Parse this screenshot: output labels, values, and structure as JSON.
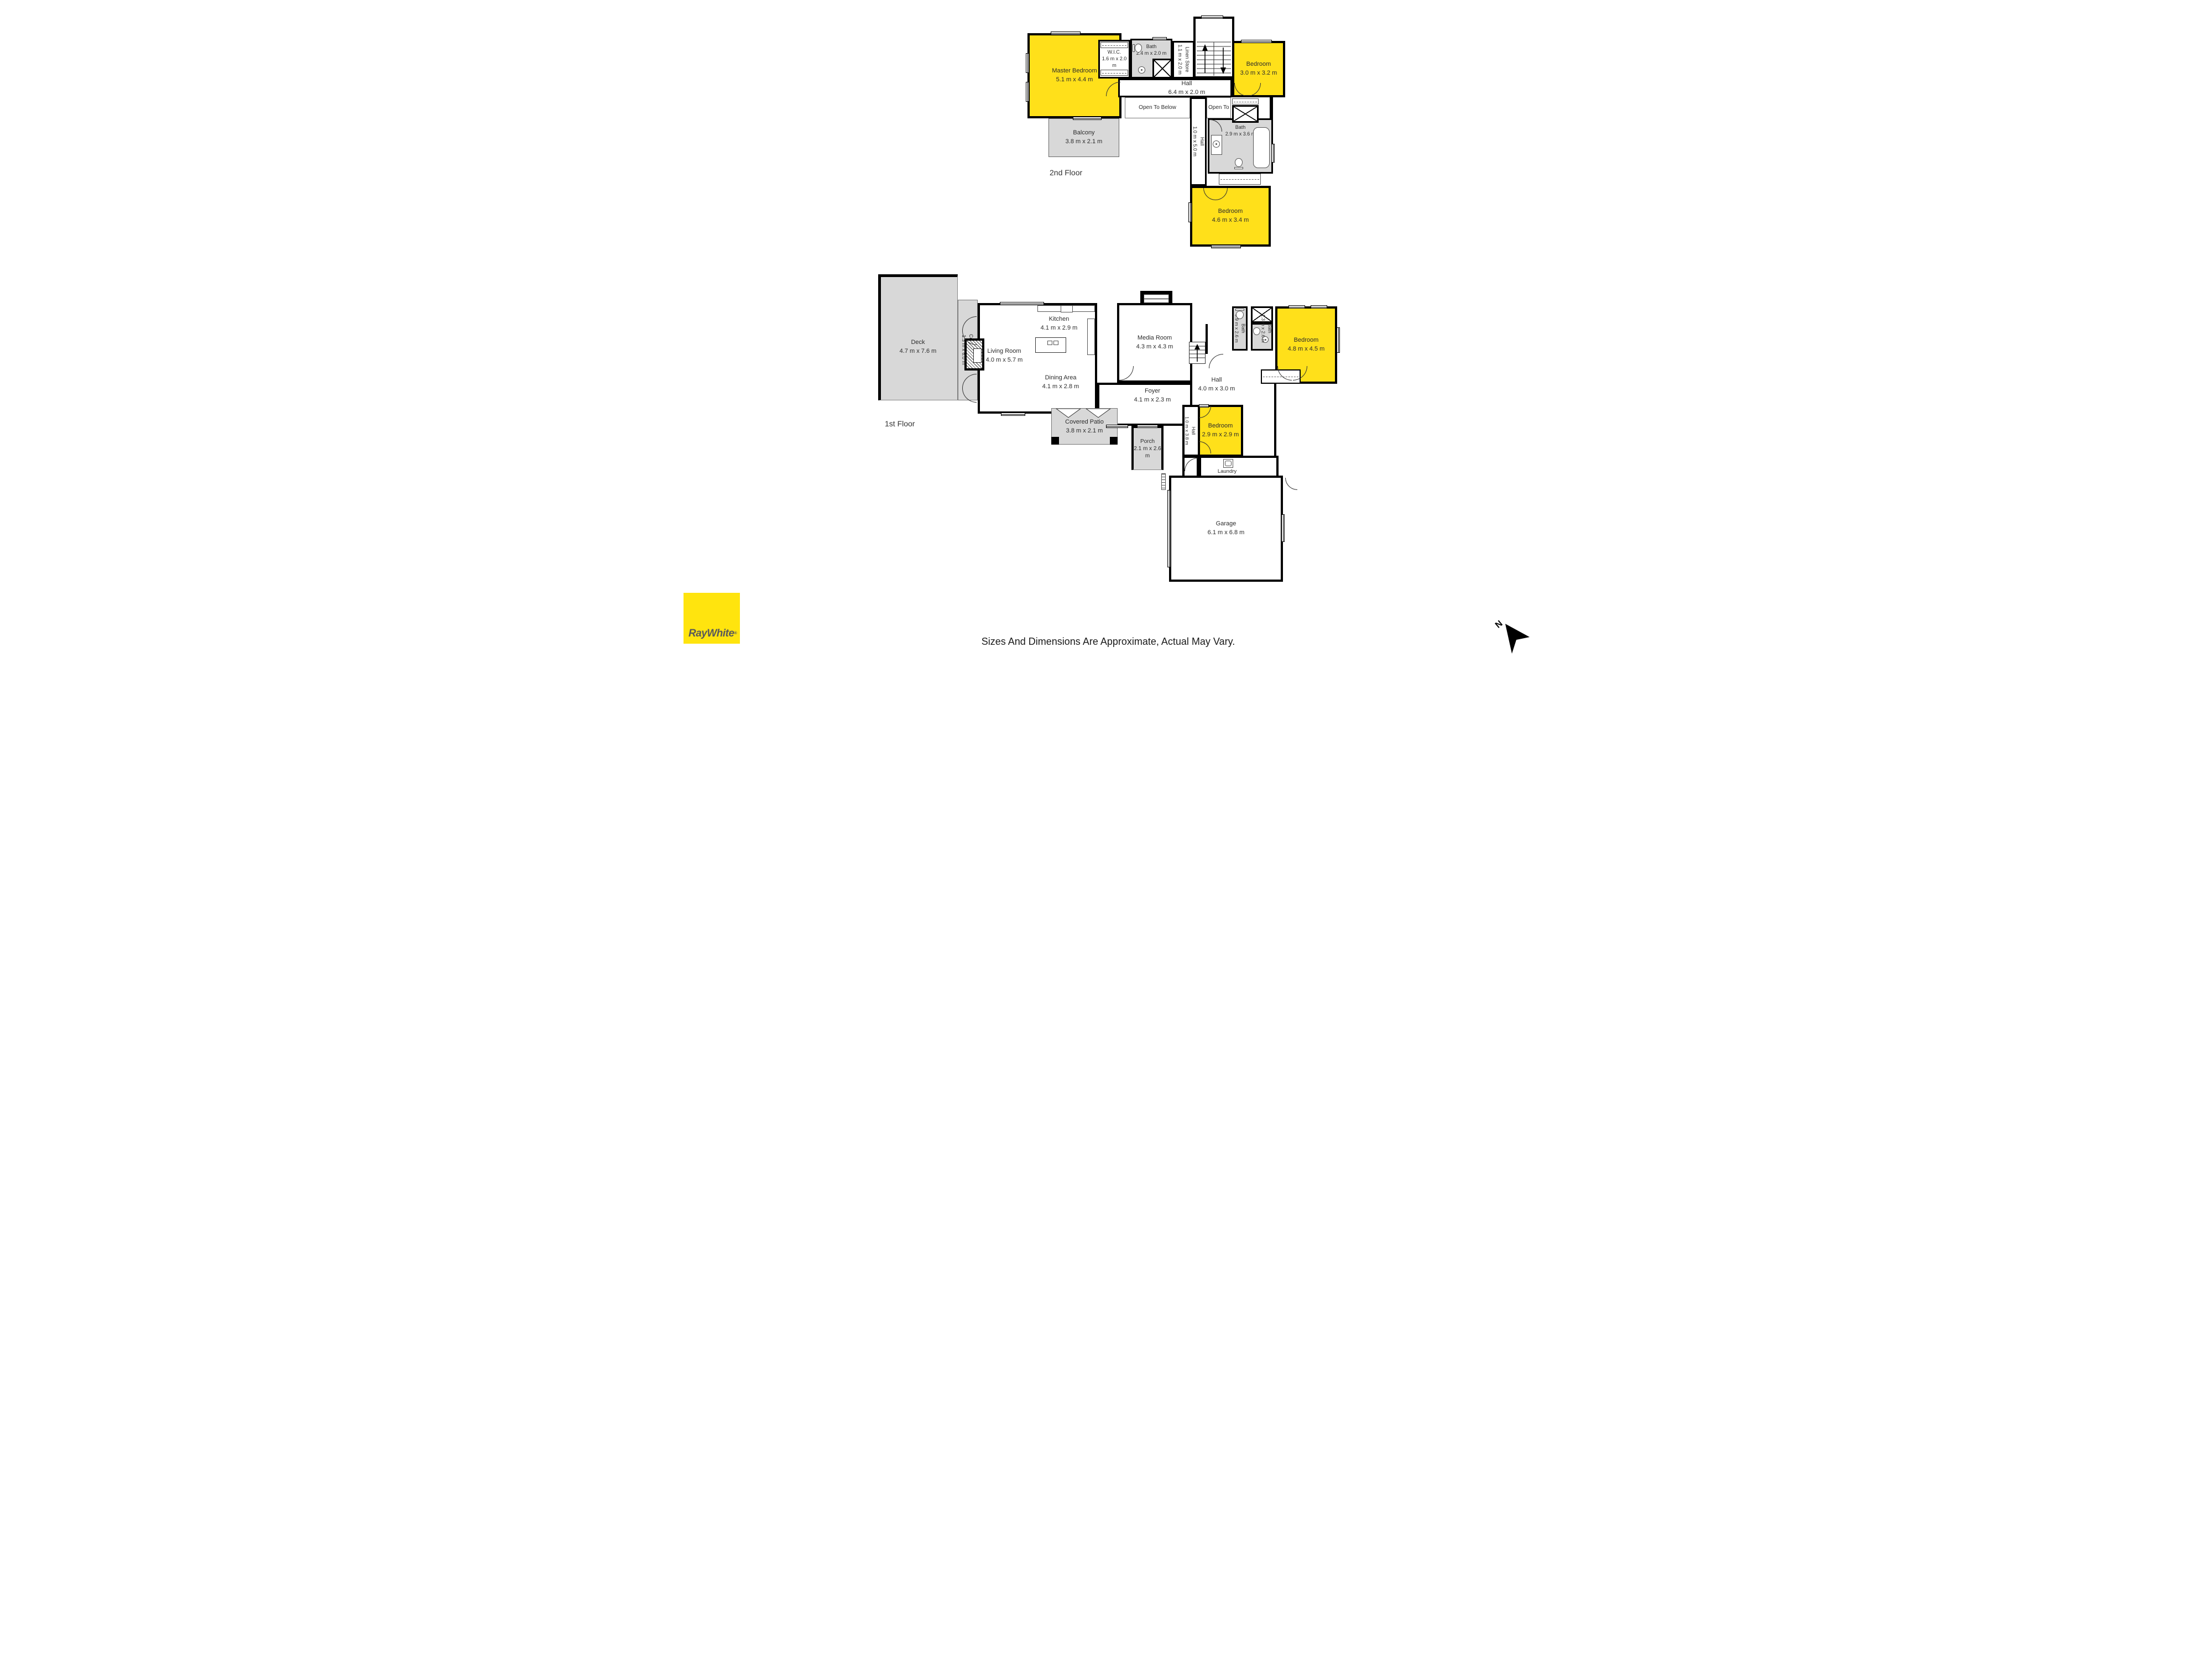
{
  "second_floor": {
    "floor_label": "2nd Floor",
    "master_bedroom": {
      "name": "Master Bedroom",
      "dims": "5.1 m x 4.4 m"
    },
    "wic": {
      "name": "W.I.C.",
      "dims": "1.6 m x 2.0 m"
    },
    "bath_a": {
      "name": "Bath",
      "dims": "2.4 m x 2.0 m"
    },
    "linen_store": {
      "name": "Linen Store",
      "dims": "1.1 m x 2.0 m"
    },
    "hall": {
      "name": "Hall",
      "dims": "6.4 m x 2.0 m"
    },
    "hall_vertical": {
      "name": "Hall",
      "dims": "1.0 m x 5.0 m"
    },
    "open_to_below_left": "Open To Below",
    "open_to_below_right": "Open To Below",
    "bedroom_ne": {
      "name": "Bedroom",
      "dims": "3.0 m x 3.2 m"
    },
    "bath_b": {
      "name": "Bath",
      "dims": "2.9 m x 3.6 m"
    },
    "bedroom_s": {
      "name": "Bedroom",
      "dims": "4.6 m x 3.4 m"
    },
    "balcony": {
      "name": "Balcony",
      "dims": "3.8 m x 2.1 m"
    }
  },
  "first_floor": {
    "floor_label": "1st Floor",
    "deck": {
      "name": "Deck",
      "dims": "4.7 m x 7.6 m"
    },
    "covered_deck": {
      "name": "Covered Deck",
      "dims": "1.3 m x 6.0 m"
    },
    "living_room": {
      "name": "Living Room",
      "dims": "4.0 m x 5.7 m"
    },
    "kitchen": {
      "name": "Kitchen",
      "dims": "4.1 m x 2.9 m"
    },
    "dining_area": {
      "name": "Dining Area",
      "dims": "4.1 m x 2.8 m"
    },
    "media_room": {
      "name": "Media Room",
      "dims": "4.3 m x 4.3 m"
    },
    "foyer": {
      "name": "Foyer",
      "dims": "4.1 m x 2.3 m"
    },
    "hall": {
      "name": "Hall",
      "dims": "4.0 m x 3.0 m"
    },
    "hall_vertical": {
      "name": "Hall",
      "dims": "1.0 m x 3.8 m"
    },
    "bath_small": {
      "name": "Bath",
      "dims": "0.9 m x 2.6 m"
    },
    "bath_ensuite": {
      "name": "Bath",
      "dims": "1.3 m x 2.6 m"
    },
    "bedroom_e": {
      "name": "Bedroom",
      "dims": "4.8 m x 4.5 m"
    },
    "bedroom_s": {
      "name": "Bedroom",
      "dims": "2.9 m x 2.9 m"
    },
    "porch": {
      "name": "Porch",
      "dims": "2.1 m x 2.6 m"
    },
    "covered_patio": {
      "name": "Covered Patio",
      "dims": "3.8 m x 2.1 m"
    },
    "laundry": {
      "name": "Laundry"
    },
    "garage": {
      "name": "Garage",
      "dims": "6.1 m x 6.8 m"
    }
  },
  "footer": {
    "logo_text": "RayWhite",
    "logo_reg": "®",
    "disclaimer": "Sizes And Dimensions Are Approximate, Actual May Vary.",
    "compass_label": "N"
  },
  "colors": {
    "room_highlight": "#FFE01A",
    "outdoor_gray": "#D8D8D8",
    "wall": "#000000",
    "logo_yellow": "#FFE40E",
    "logo_text_gray": "#58595B"
  }
}
